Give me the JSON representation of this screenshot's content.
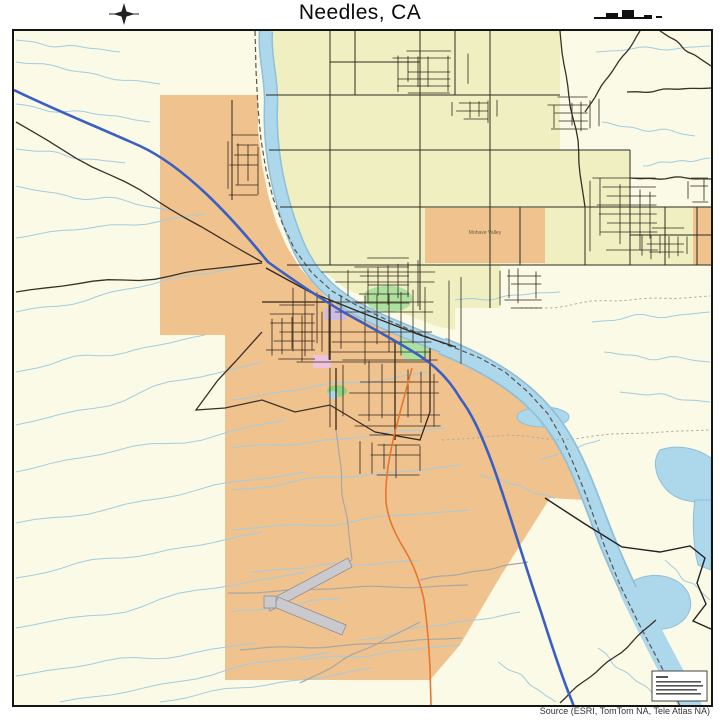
{
  "header": {
    "title": "Needles, CA",
    "compass_icon": "compass-rose",
    "scale_icon": "scale-bar"
  },
  "map": {
    "place_label": "Mohave Valley",
    "attribution": "Source (ESRI, TomTom NA, Tele Atlas NA)"
  },
  "colors": {
    "page_bg": "#FFFFFF",
    "frame": "#151515",
    "desert": "#FAFAE6",
    "valley": "#EFEFC2",
    "urban": "#F0C28E",
    "park": "#AEE0A0",
    "park_bright": "#8FD381",
    "pink": "#EFC3DD",
    "lavender": "#CBBCE4",
    "river": "#ADD7EA",
    "river_edge": "#8FBFD9",
    "wash": "#A3CCE0",
    "interstate": "#3A5FC4",
    "highway_orange": "#E8762C",
    "street": "#33281C",
    "grid_road": "#2B2B22",
    "gray_road": "#A8A8A4",
    "dark_road": "#3A3028",
    "boundary": "#555555",
    "boundary_solid": "#222222",
    "trail": "#AFAFA8",
    "runway_fill": "#C9C9CE",
    "runway_edge": "#8F8F94",
    "title_text": "#0A0A0A",
    "attribution_text": "#333333",
    "label_text": "#6B5B4B",
    "compass": "#222222",
    "scalebar": "#111111",
    "legend_box_bg": "#FFFFFF",
    "legend_box_border": "#444444",
    "legend_line": "#555555"
  }
}
